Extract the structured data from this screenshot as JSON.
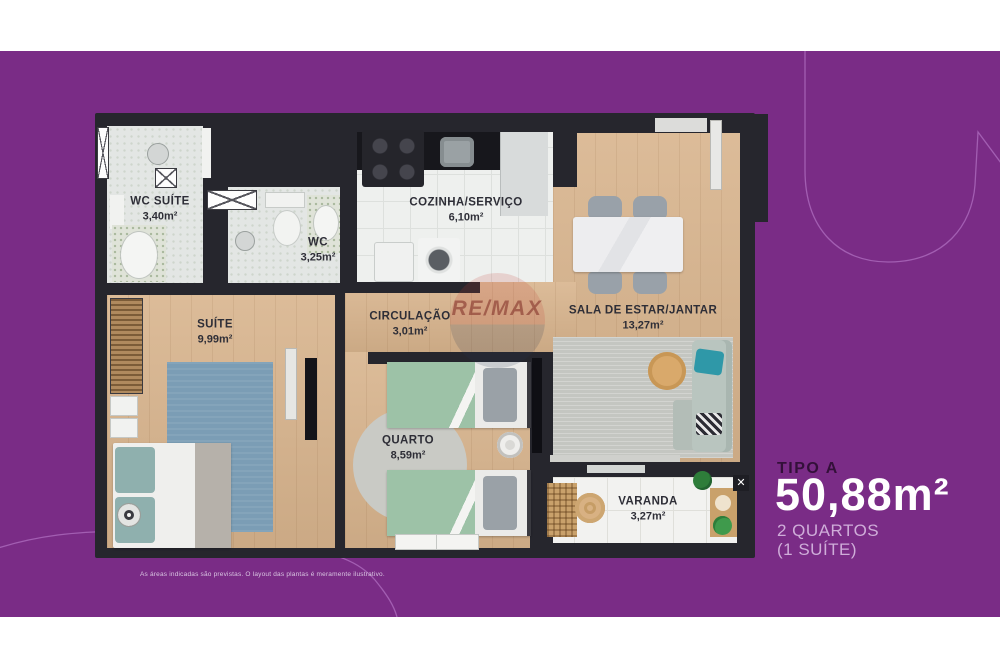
{
  "floorplan": {
    "watermark": "RE/MAX",
    "rooms": [
      {
        "id": "wc-suite",
        "label": "WC SUÍTE",
        "area": "3,40m²"
      },
      {
        "id": "wc",
        "label": "WC",
        "area": "3,25m²"
      },
      {
        "id": "cozinha",
        "label": "COZINHA/SERVIÇO",
        "area": "6,10m²"
      },
      {
        "id": "sala",
        "label": "SALA DE ESTAR/JANTAR",
        "area": "13,27m²"
      },
      {
        "id": "suite",
        "label": "SUÍTE",
        "area": "9,99m²"
      },
      {
        "id": "circulacao",
        "label": "CIRCULAÇÃO",
        "area": "3,01m²"
      },
      {
        "id": "quarto",
        "label": "QUARTO",
        "area": "8,59m²"
      },
      {
        "id": "varanda",
        "label": "VARANDA",
        "area": "3,27m²"
      }
    ]
  },
  "info": {
    "type_label": "TIPO A",
    "area_value": "50,88m²",
    "line1": "2 QUARTOS",
    "line2": "(1 SUÍTE)"
  },
  "disclaimer": "As áreas indicadas são previstas. O layout das plantas é meramente ilustrativo.",
  "colors": {
    "background_purple": "#7a2c86",
    "deco_line": "#b06fc0",
    "wall_dark": "#26262d",
    "wood_floor": "#d8b48d",
    "bath_tile": "#e3e6e4",
    "kitchen_tile": "#eef0ee",
    "balcony_tile": "#f2f2f0",
    "counter_black": "#17171c",
    "bed_green": "#9dc2a7",
    "rug_blue": "#7b9db5",
    "rug_gray": "#c4c6c1",
    "sofa_gray": "#b9c5bf",
    "pillow_teal": "#2f98a8",
    "title_dark": "#331039",
    "title_white": "#ffffff",
    "title_light_purple": "#cfadd9"
  }
}
